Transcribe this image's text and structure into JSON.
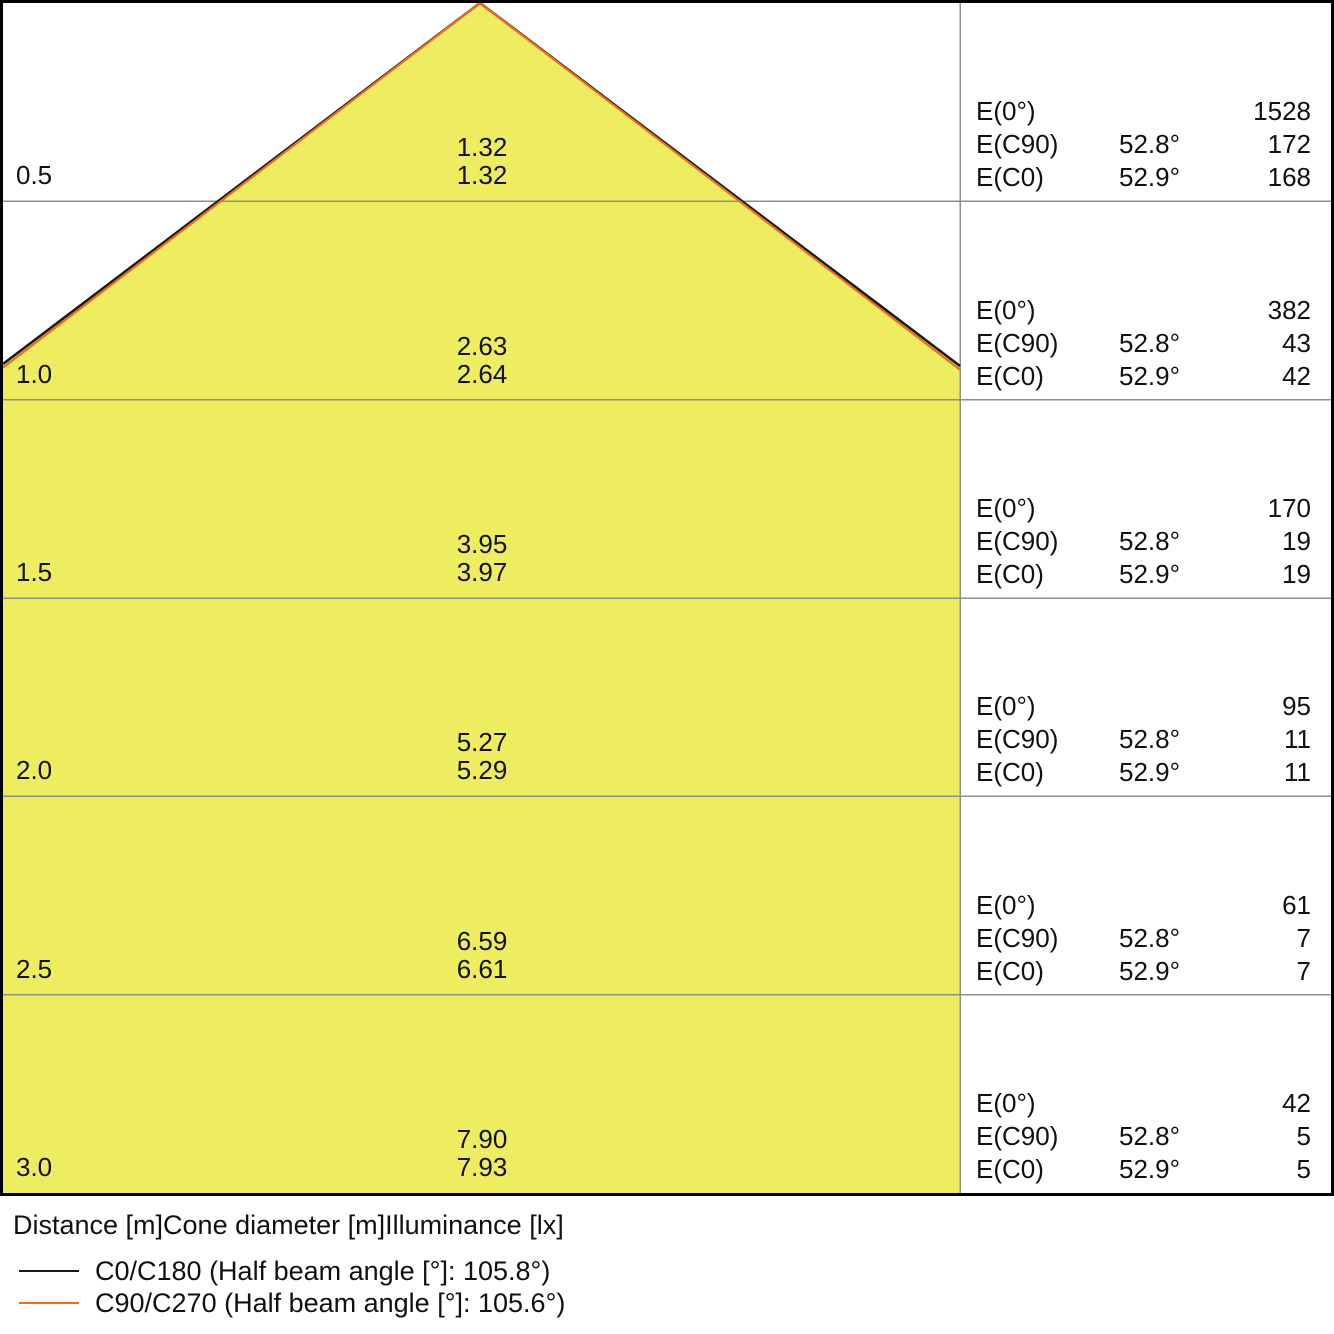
{
  "colors": {
    "cone_fill": "#eded5f",
    "c0_c180": "#1a1a1a",
    "c90_c270": "#ee6f16",
    "grid": "#8f8f8f",
    "border": "#000000"
  },
  "panel_row_labels": {
    "e0": "E(0°)",
    "ec90": "E(C90)",
    "ec0": "E(C0)"
  },
  "rows": [
    {
      "distance": "0.5",
      "dia_c90": "1.32",
      "dia_c0": "1.32",
      "e0": "1528",
      "ec90_angle": "52.8°",
      "ec90": "172",
      "ec0_angle": "52.9°",
      "ec0": "168"
    },
    {
      "distance": "1.0",
      "dia_c90": "2.63",
      "dia_c0": "2.64",
      "e0": "382",
      "ec90_angle": "52.8°",
      "ec90": "43",
      "ec0_angle": "52.9°",
      "ec0": "42"
    },
    {
      "distance": "1.5",
      "dia_c90": "3.95",
      "dia_c0": "3.97",
      "e0": "170",
      "ec90_angle": "52.8°",
      "ec90": "19",
      "ec0_angle": "52.9°",
      "ec0": "19"
    },
    {
      "distance": "2.0",
      "dia_c90": "5.27",
      "dia_c0": "5.29",
      "e0": "95",
      "ec90_angle": "52.8°",
      "ec90": "11",
      "ec0_angle": "52.9°",
      "ec0": "11"
    },
    {
      "distance": "2.5",
      "dia_c90": "6.59",
      "dia_c0": "6.61",
      "e0": "61",
      "ec90_angle": "52.8°",
      "ec90": "7",
      "ec0_angle": "52.9°",
      "ec0": "7"
    },
    {
      "distance": "3.0",
      "dia_c90": "7.90",
      "dia_c0": "7.93",
      "e0": "42",
      "ec90_angle": "52.8°",
      "ec90": "5",
      "ec0_angle": "52.9°",
      "ec0": "5"
    }
  ],
  "footer": {
    "caption": "Distance [m]Cone diameter [m]Illuminance [lx]",
    "legend": [
      {
        "label": "C0/C180 (Half beam angle [°]: 105.8°)",
        "color_key": "c0_c180"
      },
      {
        "label": "C90/C270 (Half beam angle [°]: 105.6°)",
        "color_key": "c90_c270"
      }
    ]
  },
  "chart_data": {
    "type": "table",
    "title": "Light cone diagram: distance vs cone diameter and illuminance",
    "columns": [
      "Distance [m]",
      "Cone diameter [m] (C90/C270)",
      "Cone diameter [m] (C0/C180)",
      "E(0°) [lx]",
      "E(C90) angle",
      "E(C90) [lx]",
      "E(C0) angle",
      "E(C0) [lx]"
    ],
    "rows": [
      [
        0.5,
        1.32,
        1.32,
        1528,
        "52.8°",
        172,
        "52.9°",
        168
      ],
      [
        1.0,
        2.63,
        2.64,
        382,
        "52.8°",
        43,
        "52.9°",
        42
      ],
      [
        1.5,
        3.95,
        3.97,
        170,
        "52.8°",
        19,
        "52.9°",
        19
      ],
      [
        2.0,
        5.27,
        5.29,
        95,
        "52.8°",
        11,
        "52.9°",
        11
      ],
      [
        2.5,
        6.59,
        6.61,
        61,
        "52.8°",
        7,
        "52.9°",
        7
      ],
      [
        3.0,
        7.9,
        7.93,
        42,
        "52.8°",
        5,
        "52.9°",
        5
      ]
    ],
    "legend": [
      "C0/C180 (Half beam angle [°]: 105.8°)",
      "C90/C270 (Half beam angle [°]: 105.6°)"
    ],
    "y_axis": {
      "label": "Distance [m]",
      "ticks": [
        0.5,
        1.0,
        1.5,
        2.0,
        2.5,
        3.0
      ]
    },
    "cone": {
      "apex_at_top": true,
      "half_beam_angle_c0_c180": "105.8°",
      "half_beam_angle_c90_c270": "105.6°"
    },
    "grid": true,
    "legend_position": "bottom-left"
  }
}
